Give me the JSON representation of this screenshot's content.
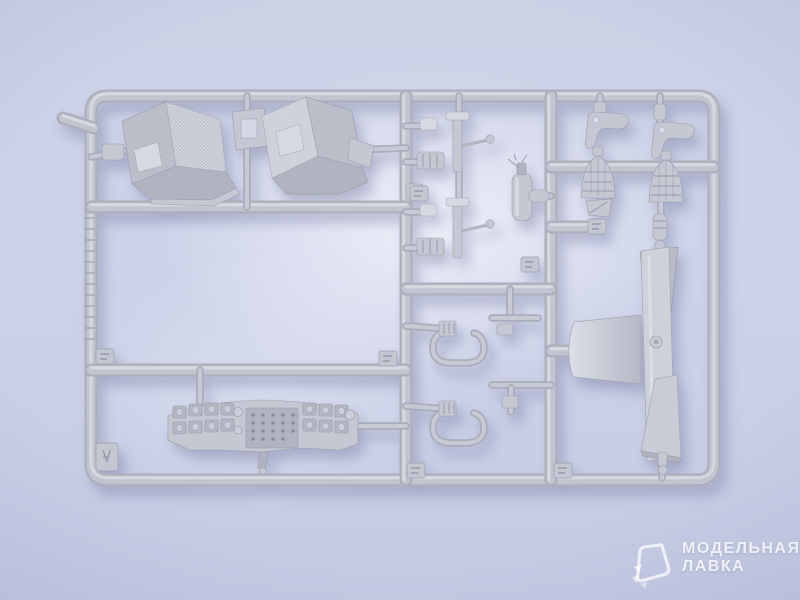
{
  "photo": {
    "subject": "Photograph of a gray injection-molded plastic model kit sprue (cockpit detail parts) on a light lavender background",
    "background_color": "#cdd2e8",
    "background_highlight": "#f0f2fa",
    "plastic_color": "#c2c5d0",
    "plastic_highlight": "#dadce4",
    "plastic_shadow": "#9aa0ad"
  },
  "sprue": {
    "parts": [
      {
        "id": "seat-left",
        "label": "cockpit bucket seat (left)"
      },
      {
        "id": "seat-right",
        "label": "cockpit bucket seat (right)"
      },
      {
        "id": "instrument-panel",
        "label": "instrument panel with gauge bezels"
      },
      {
        "id": "control-stick-upper",
        "label": "control stick assembly (upper)"
      },
      {
        "id": "control-stick-lower",
        "label": "control stick assembly (lower)"
      },
      {
        "id": "fire-extinguisher",
        "label": "small cylinder bottle (fire extinguisher)"
      },
      {
        "id": "u-tube-upper",
        "label": "U-shaped tube part (upper)"
      },
      {
        "id": "u-tube-lower",
        "label": "U-shaped tube part (lower)"
      },
      {
        "id": "hook-part-left",
        "label": "hook-shaped bracket (left)"
      },
      {
        "id": "hook-part-right",
        "label": "hook-shaped bracket (right)"
      },
      {
        "id": "cone-part-left",
        "label": "ribbed cone part (left)"
      },
      {
        "id": "cone-part-right",
        "label": "ribbed cone part (right)"
      },
      {
        "id": "cylinder-fitting",
        "label": "small cylinder fitting"
      },
      {
        "id": "armor-plate",
        "label": "large curved panel part"
      },
      {
        "id": "runner-tags",
        "label": "embossed number tags on runners"
      }
    ]
  },
  "watermark": {
    "brand_line1": "МОДЕЛЬНАЯ",
    "brand_line2": "ЛАВКА",
    "logo": "modelnaya-lavka-gem-logo",
    "text_color": "rgba(255,255,255,0.8)"
  }
}
